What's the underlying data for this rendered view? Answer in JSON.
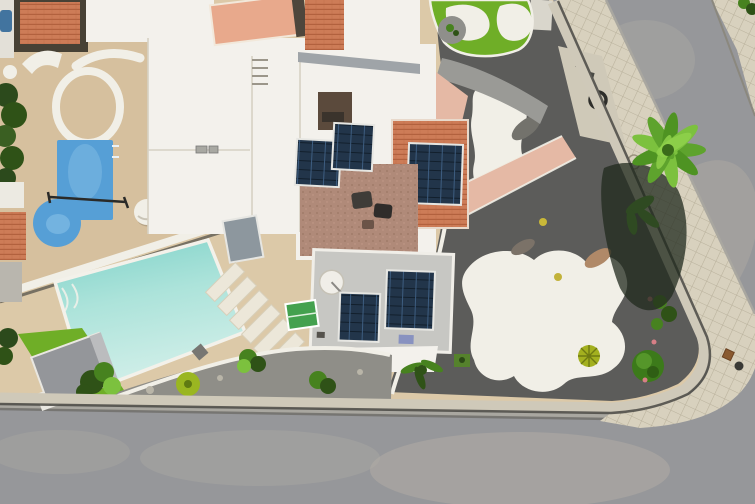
{
  "meta": {
    "scene_label": "Aerial drone view of a corner villa with swimming pool, solar panels, rock garden and street",
    "width": 755,
    "height": 504
  },
  "scene": {
    "pools": 2,
    "solar_arrays": 5,
    "sun_loungers": 6,
    "palm_trees": 1,
    "elements": [
      {
        "name": "asphalt-road",
        "label": "Asphalt road"
      },
      {
        "name": "tiled-sidewalk",
        "label": "Tiled sidewalk"
      },
      {
        "name": "perimeter-wall",
        "label": "Perimeter wall"
      },
      {
        "name": "main-pool",
        "label": "Main swimming pool"
      },
      {
        "name": "neighbor-pool",
        "label": "Neighbor swimming pool"
      },
      {
        "name": "rock-garden",
        "label": "Gravel rock garden with white paths"
      },
      {
        "name": "turf-garden",
        "label": "Artificial turf garden"
      },
      {
        "name": "solar-panel-array",
        "label": "Rooftop solar panels"
      },
      {
        "name": "palm-tree",
        "label": "Palm tree on sidewalk"
      },
      {
        "name": "garden-shed",
        "label": "Garden shed"
      },
      {
        "name": "sun-loungers",
        "label": "Sun loungers"
      },
      {
        "name": "satellite-dish",
        "label": "Satellite dish"
      }
    ]
  },
  "palette": {
    "road": "#96979a",
    "road_light": "#b3aea6",
    "apron": "#a9a7a0",
    "curb_shadow": "#6e6d68",
    "sidewalk": "#d8d1be",
    "sidewalk_line": "#b9b19c",
    "wall_top": "#cfc9b9",
    "wall_shadow": "#4a4944",
    "deck": "#dcc9a8",
    "neighbor_deck": "#d6c09e",
    "pool_deep": "#7fd2c9",
    "pool_mid": "#ace3da",
    "pool_light": "#d2efe9",
    "pool_rim": "#f3f1ea",
    "neighbor_pool": "#569fd6",
    "gravel_dark": "#5c5c5a",
    "gravel_mid": "#8f8e88",
    "path_white": "#f1efe7",
    "turf": "#6fae27",
    "concrete_path": "#9a9a96",
    "terracotta": "#cd7c57",
    "terracotta_dark": "#b2613e",
    "salmon_roof": "#e8a98c",
    "salmon_path": "#e5b9a5",
    "mauve_terrace": "#b08a79",
    "roof_white": "#f3f1ec",
    "roof_gray": "#c7c7c3",
    "roof_line": "#d6d1c3",
    "eave_gray": "#9fa4a8",
    "solar_dark": "#22354a",
    "solar_line": "#3d5d80",
    "solar_frame": "#e6e6e2",
    "shed_gray": "#94969a",
    "shed_light": "#bbbcbe",
    "plant_dark": "#2f5217",
    "plant_mid": "#47821f",
    "plant_light": "#7cc13e",
    "palm_green": "#5ea32d",
    "palm_mid": "#4e9322",
    "palm_hi": "#8ed04a",
    "palm_core": "#3a6b1a",
    "palm_dark": "#2f4a22",
    "palm_shadow": "#20291d",
    "cactus": "#a3b01f",
    "succulent": "#9ab621",
    "bush_green": "#3c7a1a",
    "furniture_dark": "#454240",
    "rock_gray": "#73726c",
    "rock_red": "#b08968",
    "flower_pink": "#d77f86",
    "teal_box": "#3f8e86",
    "green_table": "#44a14f",
    "dish_white": "#f0eee8",
    "courtyard_brown": "#5b4a3c",
    "driveway": "#cfc9b8",
    "blue_item": "#8892c0",
    "divider_shadow": "#55534c"
  }
}
